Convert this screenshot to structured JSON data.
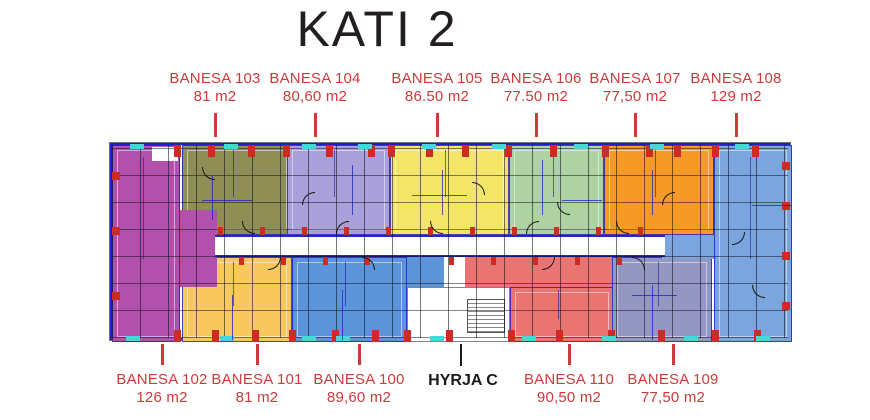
{
  "title": "KATI 2",
  "entrance": {
    "label": "HYRJA C"
  },
  "units": {
    "u100": {
      "name": "BANESA 100",
      "area": "89,60 m2",
      "color": "#5b94d9"
    },
    "u101": {
      "name": "BANESA 101",
      "area": "81 m2",
      "color": "#f8c85e"
    },
    "u102": {
      "name": "BANESA 102",
      "area": "126 m2",
      "color": "#b151ac"
    },
    "u103": {
      "name": "BANESA 103",
      "area": "81 m2",
      "color": "#8f8f55"
    },
    "u104": {
      "name": "BANESA 104",
      "area": "80,60 m2",
      "color": "#a99fd9"
    },
    "u105": {
      "name": "BANESA 105",
      "area": "86.50 m2",
      "color": "#f3e567"
    },
    "u106": {
      "name": "BANESA 106",
      "area": "77.50 m2",
      "color": "#aed2a2"
    },
    "u107": {
      "name": "BANESA 107",
      "area": "77,50 m2",
      "color": "#f59a25"
    },
    "u108": {
      "name": "BANESA 108",
      "area": "129 m2",
      "color": "#7aa6dd"
    },
    "u109": {
      "name": "BANESA 109",
      "area": "77,50 m2",
      "color": "#9497c2"
    },
    "u110": {
      "name": "BANESA 110",
      "area": "90,50 m2",
      "color": "#ea7472"
    }
  },
  "colors": {
    "label_red": "#cc3a3a",
    "title_black": "#231f20",
    "wall_blue": "#2525c8",
    "pier_red": "#cf2b25",
    "balcony_cyan": "#45d8d6",
    "corridor_white": "#ffffff"
  }
}
